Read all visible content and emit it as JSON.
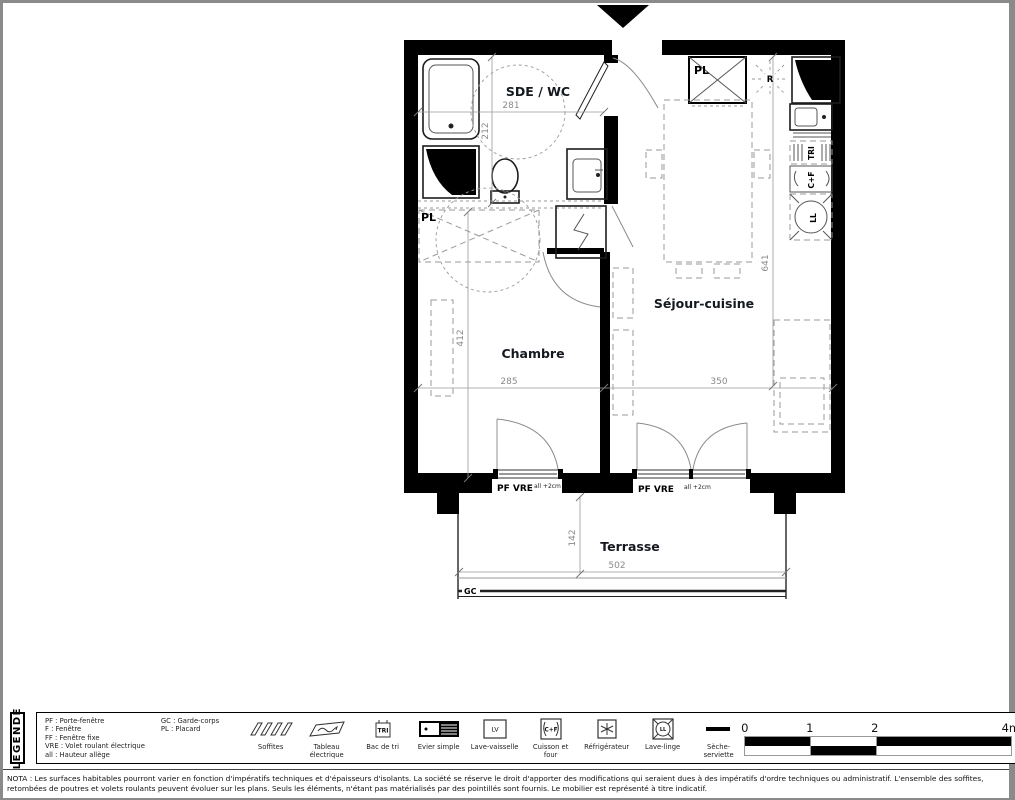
{
  "plan": {
    "rooms": {
      "sde_wc": {
        "label": "SDE / WC",
        "width_cm": "281",
        "height_cm": "212"
      },
      "chambre": {
        "label": "Chambre",
        "width_cm": "285",
        "height_cm": "412"
      },
      "sejour_cuisine": {
        "label": "Séjour-cuisine",
        "width_cm": "350",
        "height_cm": "641"
      },
      "terrasse": {
        "label": "Terrasse",
        "width_cm": "502",
        "height_cm": "142"
      }
    },
    "labels": {
      "closet_chambre": "PL",
      "closet_entry": "PL",
      "fridge": "R",
      "recycling": "TRI",
      "cooking": "C+F",
      "washer": "LL",
      "railing": "GC"
    },
    "doors": {
      "door_chambre": {
        "label": "PF VRE",
        "note": "all +2cm"
      },
      "door_sejour": {
        "label": "PF VRE",
        "note": "all +2cm"
      }
    }
  },
  "legend": {
    "title": "LEGENDE",
    "abbreviations_left": [
      "PF : Porte-fenêtre",
      "F : Fenêtre",
      "FF : Fenêtre fixe",
      "VRE : Volet roulant électrique",
      "all : Hauteur allège"
    ],
    "abbreviations_right": [
      "GC : Garde-corps",
      "PL : Placard"
    ],
    "items": [
      {
        "icon": "soffits-icon",
        "label": "Soffites"
      },
      {
        "icon": "electrical-panel-icon",
        "label": "Tableau électrique"
      },
      {
        "icon": "recycling-bin-icon",
        "label": "Bac de tri",
        "glyph": "TRI"
      },
      {
        "icon": "single-sink-icon",
        "label": "Evier simple"
      },
      {
        "icon": "dishwasher-icon",
        "label": "Lave-vaisselle",
        "glyph": "LV"
      },
      {
        "icon": "cooktop-oven-icon",
        "label": "Cuisson et four",
        "glyph": "C+F"
      },
      {
        "icon": "fridge-icon",
        "label": "Réfrigérateur"
      },
      {
        "icon": "washing-machine-icon",
        "label": "Lave-linge",
        "glyph": "LL"
      },
      {
        "icon": "towel-dryer-icon",
        "label": "Sèche-serviette"
      }
    ],
    "scale_ticks": [
      "0",
      "1",
      "2",
      "4m"
    ]
  },
  "nota": "NOTA : Les surfaces habitables pourront varier en fonction d'impératifs techniques et d'épaisseurs d'isolants. La société se réserve le droit d'apporter des modifications qui seraient dues à des impératifs d'ordre techniques ou administratif. L'ensemble des soffites, retombées de poutres et volets roulants peuvent évoluer sur les plans. Seuls les éléments, n'étant pas matérialisés par des pointillés sont fournis. Le mobilier est représenté à titre indicatif.",
  "colors": {
    "wall": "#000000",
    "dimension": "#8a8a8a",
    "furniture_dash": "#9a9a9a"
  }
}
